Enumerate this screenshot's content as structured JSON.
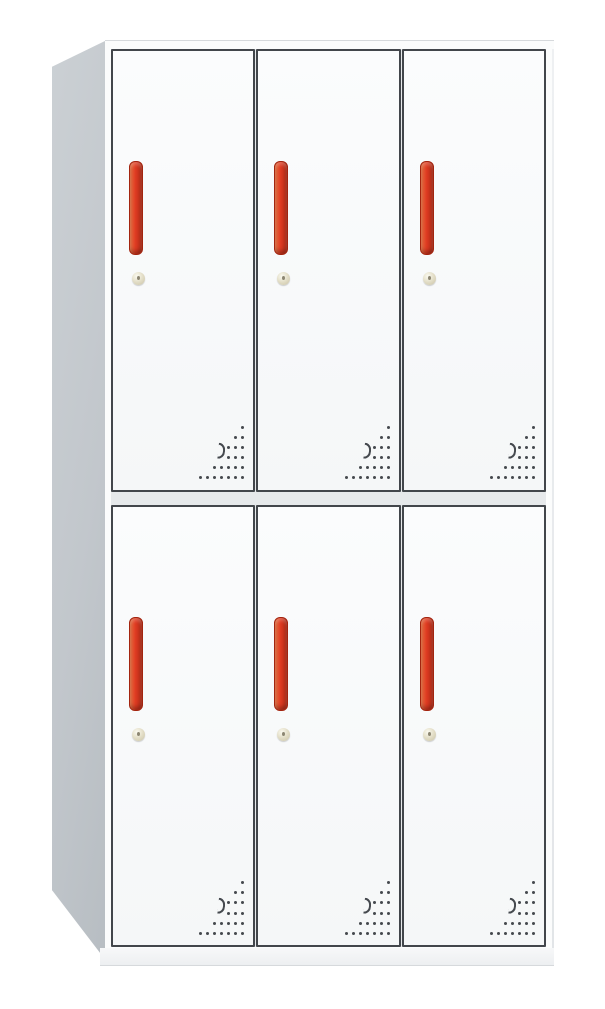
{
  "product": {
    "name": "six-door steel locker cabinet",
    "scene": "plain white background, slight left-side perspective",
    "structure": {
      "door_rows": 2,
      "door_columns": 3,
      "door_count": 6,
      "has_left_side_panel": true,
      "has_base_plinth": true
    },
    "colors": {
      "body": "#fbfcfc",
      "side_panel": "#c2c7cc",
      "door_face": "#fbfcfd",
      "door_border": "#42464b",
      "frame_gap": "#e6e9eb",
      "handle_red": "#df3b22",
      "handle_red_dark": "#b02a16",
      "handle_red_light": "#ef7342",
      "keyhole_brass": "#e2ddc6",
      "vent_dot": "#45494e",
      "background": "#ffffff"
    },
    "door_features": {
      "handle": "vertical red bar handle, upper-left of door",
      "lock": "small round cam-lock keyhole below handle",
      "vent": "triangular dot perforation pattern, lower-right corner of door"
    },
    "vent": {
      "rows_top_to_bottom": [
        1,
        2,
        3,
        3,
        5,
        7
      ],
      "has_crescent_hole": true
    },
    "doors": [
      {
        "id": "r1c1",
        "row": 1,
        "col": 1
      },
      {
        "id": "r1c2",
        "row": 1,
        "col": 2
      },
      {
        "id": "r1c3",
        "row": 1,
        "col": 3
      },
      {
        "id": "r2c1",
        "row": 2,
        "col": 1
      },
      {
        "id": "r2c2",
        "row": 2,
        "col": 2
      },
      {
        "id": "r2c3",
        "row": 2,
        "col": 3
      }
    ]
  }
}
